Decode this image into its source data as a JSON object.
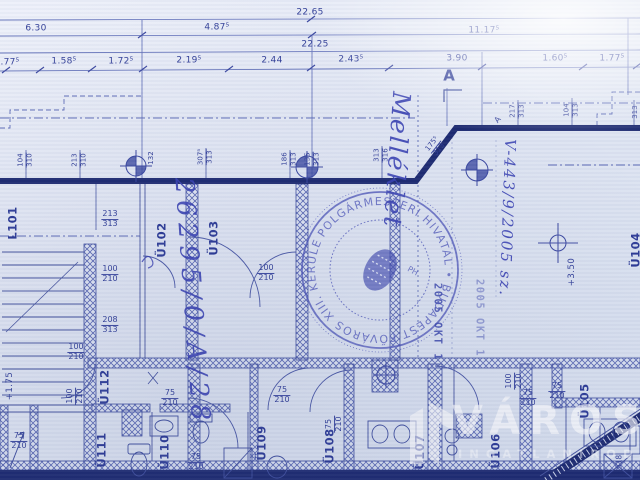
{
  "document_kind": "scanned architectural floor plan (blueprint)",
  "dimension_rows": {
    "overall_top": "22.65",
    "row2": [
      "6.30",
      "4.87⁵",
      "11.17⁵"
    ],
    "overall_mid": "22.25",
    "row4": [
      "1.77⁵",
      "1.58⁵",
      "1.72⁵",
      "2.19⁵",
      "2.44",
      "2.43⁵",
      "3.90",
      "1.60⁵",
      "1.77⁵"
    ]
  },
  "wall_dims": [
    {
      "n": "104",
      "d": "310"
    },
    {
      "n": "213",
      "d": "310"
    },
    {
      "n": "132",
      "d": ""
    },
    {
      "n": "307⁵",
      "d": "313"
    },
    {
      "n": "186",
      "d": "313"
    },
    {
      "n": "135",
      "d": "313"
    },
    {
      "n": "313",
      "d": "316"
    },
    {
      "n": "175⁵",
      "d": "313"
    },
    {
      "n": "217",
      "d": "313"
    },
    {
      "n": "104",
      "d": "313"
    },
    {
      "n": "313",
      "d": ""
    }
  ],
  "openings": [
    {
      "n": "213",
      "d": "313"
    },
    {
      "n": "100",
      "d": "210"
    },
    {
      "n": "208",
      "d": "313"
    },
    {
      "n": "100",
      "d": "210"
    },
    {
      "n": "100",
      "d": "210"
    },
    {
      "n": "100",
      "d": "210"
    },
    {
      "n": "75",
      "d": "210"
    },
    {
      "n": "75",
      "d": "210"
    },
    {
      "n": "75",
      "d": "210"
    },
    {
      "n": "75",
      "d": "210"
    },
    {
      "n": "75",
      "d": "210"
    },
    {
      "n": "100",
      "d": "210"
    },
    {
      "n": "75",
      "d": "210"
    },
    {
      "n": "75",
      "d": "210"
    },
    {
      "n": "518",
      "d": ""
    }
  ],
  "rooms": [
    "L101",
    "Ü102",
    "Ü103",
    "Ü104",
    "Ü105",
    "Ü106",
    "Ü107",
    "Ü108",
    "Ü109",
    "Ü110",
    "Ü111",
    "Ü112"
  ],
  "levels": {
    "upper": "+3.50",
    "lower": "+1.75"
  },
  "markers": {
    "section": "A",
    "section_small": "A"
  },
  "handwriting": {
    "file_number": "26295/0/A/28",
    "note": "Melléklet",
    "case_number": "V-443/9/2005 sz."
  },
  "stamp": {
    "ring": "POLGÁRMESTERI HIVATAL • BUDAPEST FŐVÁROS XIII. KERÜLET •",
    "monogram": "PH",
    "date": "2005 OKT 1",
    "date2": "2005 OKT 1"
  },
  "watermark": {
    "brand": "VÁROSI",
    "tagline": "INGATLANIRODA"
  }
}
